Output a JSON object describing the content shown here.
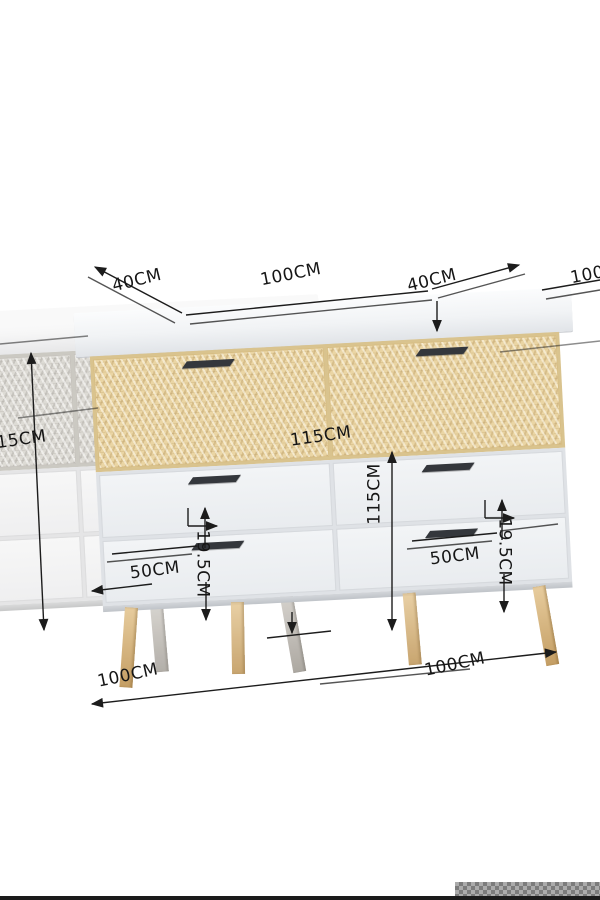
{
  "image": {
    "type": "product-dimension-diagram",
    "subject": "rattan sideboard cabinet with six drawers and gold legs"
  },
  "colors": {
    "background": "#ffffff",
    "rattan": "#ead5a4",
    "cabinet_body": "#eff1f3",
    "legs": "#d2ac76",
    "dimension_lines": "#1c1c1c",
    "watermark_strip": "#9d9d9d"
  },
  "dimensions": {
    "depth_top_left": "40CM",
    "width_top": "100CM",
    "depth_top_right": "40CM",
    "width_top_right_clipped": "100CM",
    "height_left_clipped": "115CM",
    "height_center": "115CM",
    "height_vertical": "115CM",
    "drawer_width_left": "50CM",
    "drawer_width_right": "50CM",
    "drawer_height_left": "19.5CM",
    "drawer_height_right": "19.5CM",
    "width_bottom": "100CM",
    "width_bottom_ghost": "100CM"
  }
}
